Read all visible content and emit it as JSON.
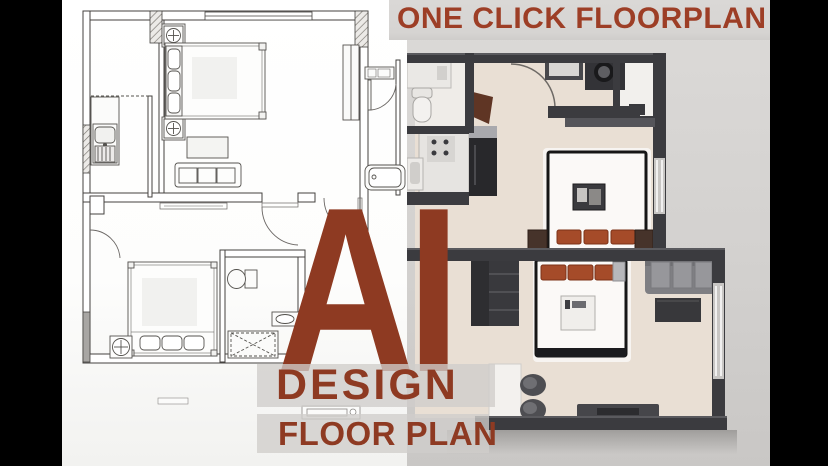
{
  "stage": {
    "width": 828,
    "height": 466,
    "letterbox_color": "#000000"
  },
  "headline": {
    "text": "ONE CLICK FLOORPLAN",
    "color": "#9d3e26",
    "band_color": "#d8d6d4"
  },
  "overlay": {
    "title": "AI",
    "subtitle": "DESIGN",
    "subtitle2": "FLOOR PLAN",
    "text_color": "#8e3a22",
    "band_color": "rgba(207,205,202,0.78)"
  },
  "left_panel": {
    "name": "2d-floorplan-drawing",
    "paper_color": "#ffffff",
    "ink_color": "#4a4845"
  },
  "right_panel": {
    "name": "3d-floorplan-render",
    "background_color": "#d8d6d4",
    "wall_color": "#3b3b3f",
    "floor_color": "#e9dfd4",
    "bed_color": "#fbf9f7",
    "cushion_color": "#a54b29",
    "sofa_color": "#7f7f83"
  }
}
